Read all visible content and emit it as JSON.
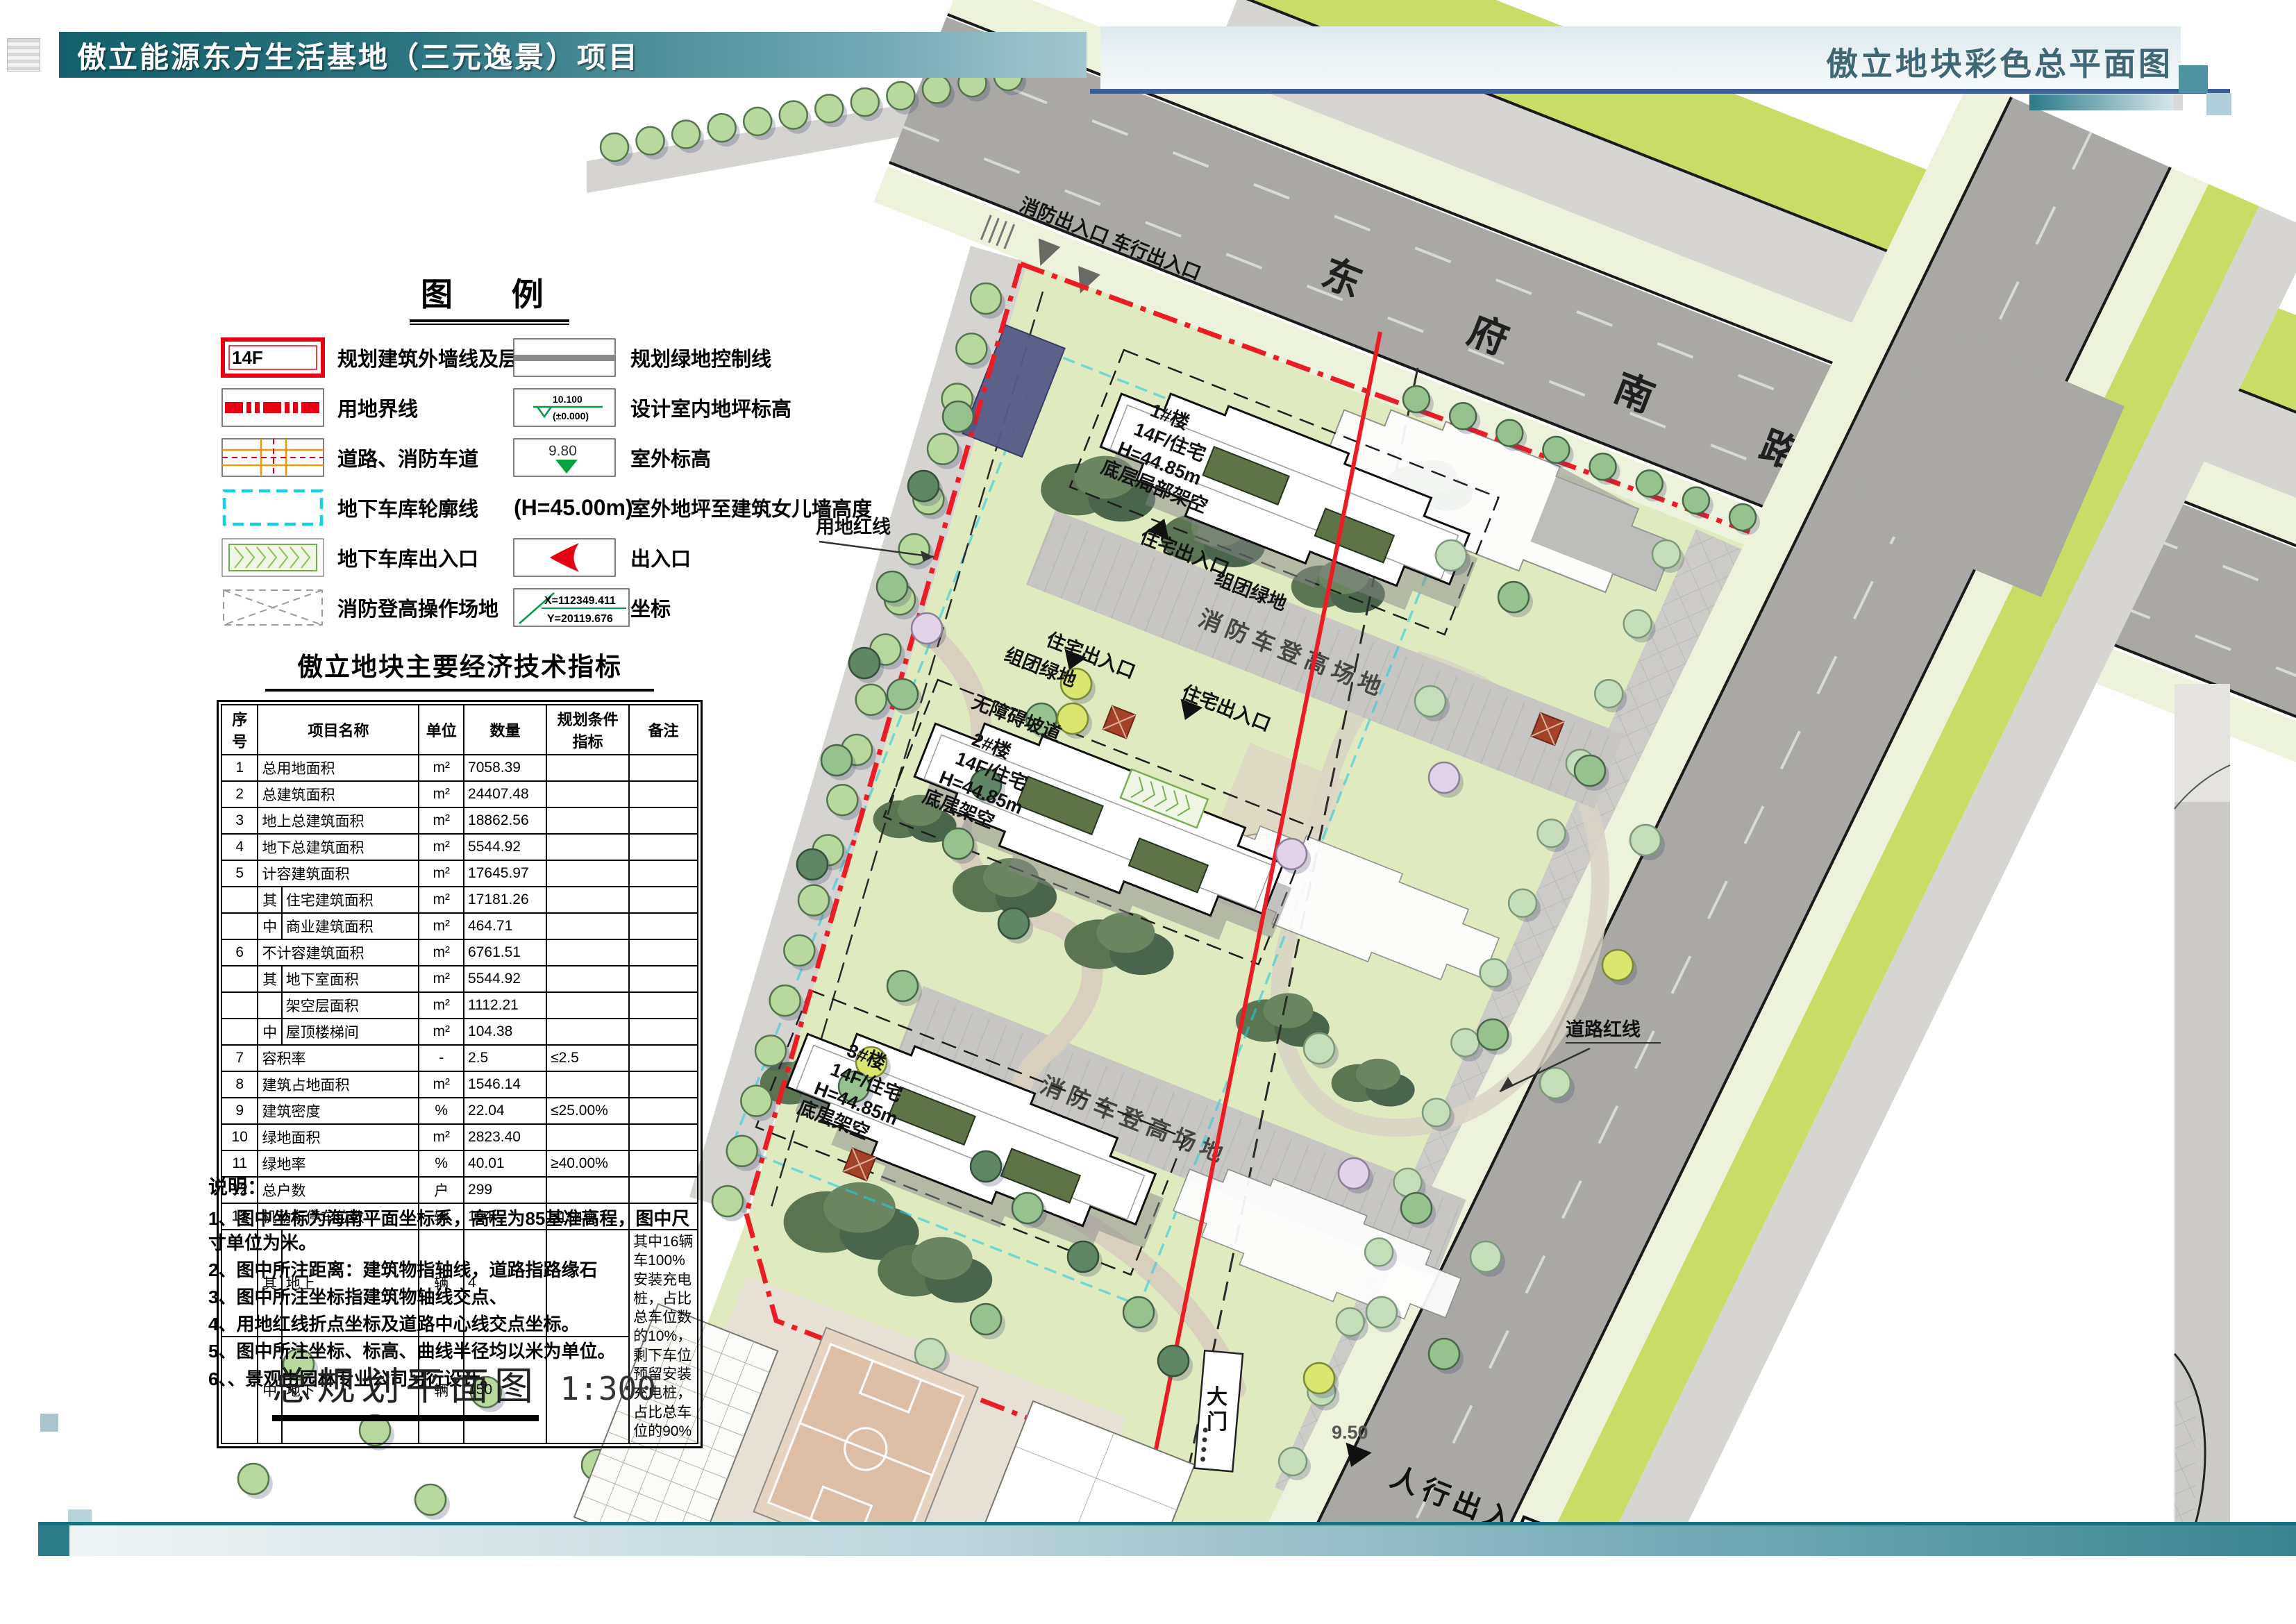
{
  "header": {
    "title": "傲立能源东方生活基地（三元逸景）项目",
    "right_title": "傲立地块彩色总平面图"
  },
  "legend": {
    "title": "图  例",
    "left": [
      {
        "label": "规划建筑外墙线及层数",
        "value": "14F"
      },
      {
        "label": "用地界线"
      },
      {
        "label": "道路、消防车道"
      },
      {
        "label": "地下车库轮廓线"
      },
      {
        "label": "地下车库出入口"
      },
      {
        "label": "消防登高操作场地"
      }
    ],
    "right": [
      {
        "label": "规划绿地控制线"
      },
      {
        "label": "设计室内地坪标高",
        "value_top": "10.100",
        "value_bottom": "(±0.000)"
      },
      {
        "label": "室外标高",
        "value": "9.80"
      },
      {
        "label": "室外地坪至建筑女儿墙高度",
        "value": "(H=45.00m)"
      },
      {
        "label": "出入口"
      },
      {
        "label": "坐标",
        "value_x": "X=112349.411",
        "value_y": "Y=20119.676"
      }
    ]
  },
  "table": {
    "title": "傲立地块主要经济技术指标",
    "headers": [
      "序号",
      "项目名称",
      "单位",
      "数量",
      "规划条件指标",
      "备注"
    ],
    "rows": [
      [
        "1",
        null,
        "总用地面积",
        "m²",
        "7058.39",
        "",
        ""
      ],
      [
        "2",
        null,
        "总建筑面积",
        "m²",
        "24407.48",
        "",
        ""
      ],
      [
        "3",
        null,
        "地上总建筑面积",
        "m²",
        "18862.56",
        "",
        ""
      ],
      [
        "4",
        null,
        "地下总建筑面积",
        "m²",
        "5544.92",
        "",
        ""
      ],
      [
        "5",
        null,
        "计容建筑面积",
        "m²",
        "17645.97",
        "",
        ""
      ],
      [
        null,
        "其",
        "住宅建筑面积",
        "m²",
        "17181.26",
        "",
        ""
      ],
      [
        null,
        "中",
        "商业建筑面积",
        "m²",
        "464.71",
        "",
        ""
      ],
      [
        "6",
        null,
        "不计容建筑面积",
        "m²",
        "6761.51",
        "",
        ""
      ],
      [
        null,
        "其",
        "地下室面积",
        "m²",
        "5544.92",
        "",
        ""
      ],
      [
        null,
        "",
        "架空层面积",
        "m²",
        "1112.21",
        "",
        ""
      ],
      [
        null,
        "中",
        "屋顶楼梯间",
        "m²",
        "104.38",
        "",
        ""
      ],
      [
        "7",
        null,
        "容积率",
        "-",
        "2.5",
        "≤2.5",
        ""
      ],
      [
        "8",
        null,
        "建筑占地面积",
        "m²",
        "1546.14",
        "",
        ""
      ],
      [
        "9",
        null,
        "建筑密度",
        "%",
        "22.04",
        "≤25.00%",
        ""
      ],
      [
        "10",
        null,
        "绿地面积",
        "m²",
        "2823.40",
        "",
        ""
      ],
      [
        "11",
        null,
        "绿地率",
        "%",
        "40.01",
        "≥40.00%",
        ""
      ],
      [
        "12",
        null,
        "总户数",
        "户",
        "299",
        "",
        ""
      ],
      [
        "13",
        null,
        "机动车停车位数",
        "辆",
        "154",
        "≥154辆",
        ""
      ],
      [
        null,
        "其",
        "地上",
        "辆",
        "4",
        "",
        "PARKING_NOTE"
      ],
      [
        null,
        "中",
        "地下",
        "辆",
        "150",
        "",
        "SKIP"
      ]
    ],
    "parking_note": "其中16辆车100%安装充电桩，占比总车位数的10%，剩下车位预留安装充电桩，占比总车位的90%"
  },
  "notes": {
    "title": "说明：",
    "items": [
      "1、图中坐标为海南平面坐标系，高程为85基准高程，图中尺寸单位为米。",
      "2、图中所注距离：建筑物指轴线，道路指路缘石",
      "3、图中所注坐标指建筑物轴线交点、",
      "4、用地红线折点坐标及道路中心线交点坐标。",
      "5、图中所注坐标、标高、曲线半径均以米为单位。",
      "6、、景观由园林专业公司另行设计。"
    ]
  },
  "plan_title": {
    "text": "总规划平面图",
    "scale": "1:300"
  },
  "plan": {
    "road_name": "东府南路",
    "entrance_top": "消防出入口 车行出入口",
    "site_redline_label": "用地红线",
    "road_redline_label": "道路红线",
    "fire_field_label": "消防车登高场地",
    "resident_entrance_label": "住宅出入口",
    "cluster_green_label": "组团绿地",
    "ramp_label": "无障碍坡道",
    "gate_label": "大门",
    "ped_entrance_label": "人行出入口",
    "elev_label": "9.50",
    "buildings": [
      {
        "name": "1#楼",
        "type": "14F/住宅",
        "height": "H=44.85m",
        "note": "底层局部架空"
      },
      {
        "name": "2#楼",
        "type": "14F/住宅",
        "height": "H=44.85m",
        "note": "底层架空"
      },
      {
        "name": "3#楼",
        "type": "14F/住宅",
        "height": "H=44.85m",
        "note": "底层架空"
      }
    ]
  }
}
